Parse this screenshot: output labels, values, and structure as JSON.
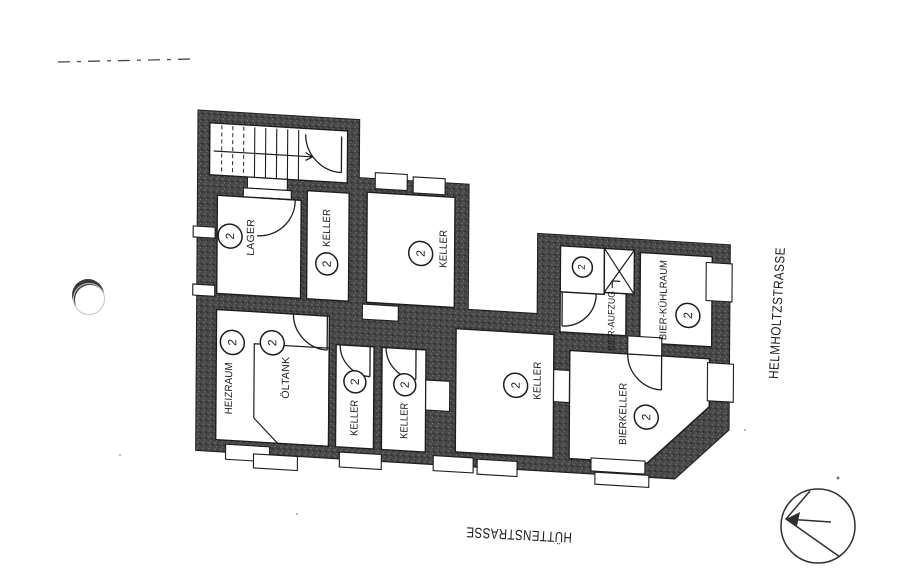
{
  "plan": {
    "rooms": [
      {
        "name": "lager",
        "label": "LAGER",
        "occupancy": "2"
      },
      {
        "name": "keller-upper-small",
        "label": "KELLER",
        "occupancy": "2"
      },
      {
        "name": "keller-upper",
        "label": "KELLER",
        "occupancy": "2"
      },
      {
        "name": "heizraum",
        "label": "HEIZRAUM",
        "occupancy": "2"
      },
      {
        "name": "oeltank",
        "label": "ÖLTANK",
        "occupancy": "2"
      },
      {
        "name": "keller-lower-1",
        "label": "KELLER",
        "occupancy": "2"
      },
      {
        "name": "keller-lower-2",
        "label": "KELLER",
        "occupancy": "2"
      },
      {
        "name": "keller-center",
        "label": "KELLER",
        "occupancy": "2"
      },
      {
        "name": "bier-aufzug",
        "label": "BIER-AUFZUG",
        "occupancy": "2"
      },
      {
        "name": "bier-kuehlraum",
        "label": "BIER-KÜHLRAUM",
        "occupancy": "2"
      },
      {
        "name": "bierkeller",
        "label": "BIERKELLER",
        "occupancy": "2"
      }
    ],
    "streets": {
      "right": "HELMHOLTZSTRASSE",
      "bottom": "HÜTTENSTRASSE"
    },
    "colors": {
      "wall": "#424242",
      "ink": "#1d1d1d",
      "paper": "#ffffff"
    }
  }
}
